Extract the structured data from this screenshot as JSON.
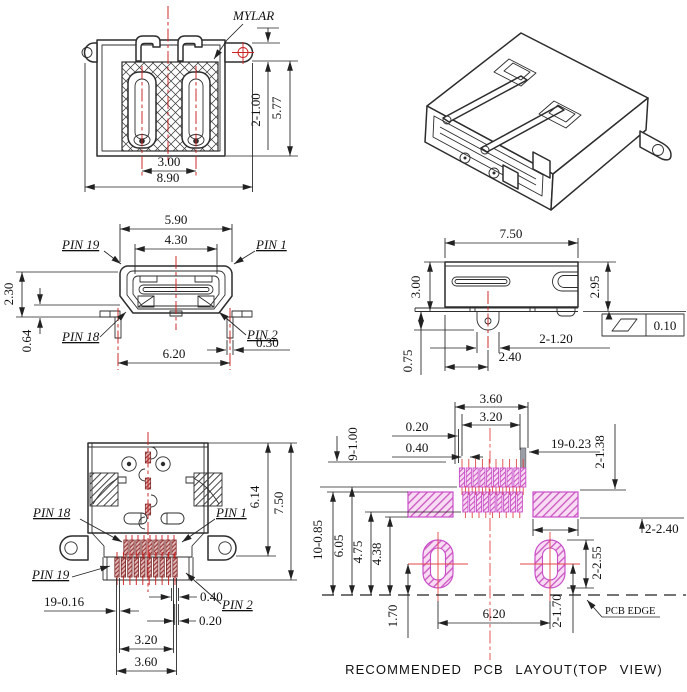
{
  "caption": "RECOMMENDED PCB LAYOUT(TOP VIEW)",
  "views": {
    "rear": {
      "mylar": "MYLAR",
      "ear_hole": "2-1.00",
      "height": "5.77",
      "pitch": "3.00",
      "overall_width": "8.90"
    },
    "front": {
      "top_width": "5.90",
      "opening_width": "4.30",
      "pin19": "PIN 19",
      "pin1": "PIN 1",
      "pin18": "PIN 18",
      "pin2": "PIN 2",
      "opening_height": "2.30",
      "lip": "0.64",
      "leg_span": "6.20",
      "leg_width": "0.30"
    },
    "side": {
      "width": "7.50",
      "height_left": "3.00",
      "height_right": "2.95",
      "legs": "2-1.20",
      "hole_offset": "2.40",
      "standoff": "0.75",
      "flatness": "0.10"
    },
    "top": {
      "pin18": "PIN 18",
      "pin1": "PIN 1",
      "pin19": "PIN 19",
      "pin2": "PIN 2",
      "body_depth": "6.14",
      "total_depth": "7.50",
      "tail_width": "19-0.16",
      "pin_w1": "0.40",
      "pin_w2": "0.20",
      "span_inner": "3.20",
      "span_outer": "3.60"
    },
    "pcb": {
      "span_outer": "3.60",
      "span_inner": "3.20",
      "gap": "0.20",
      "pitch": "0.40",
      "pad_width": "19-0.23",
      "lock_pad_h": "2-1.38",
      "pad_len_top": "9-1.00",
      "pad_len_bot": "10-0.85",
      "depth_a": "6.05",
      "depth_b": "4.75",
      "depth_c": "4.38",
      "lock_pad_w": "2-2.40",
      "slot_h": "2-2.55",
      "slot_span": "6.20",
      "edge_off": "1.70",
      "slot_edge": "2-1.70",
      "edge_label": "PCB EDGE"
    }
  }
}
